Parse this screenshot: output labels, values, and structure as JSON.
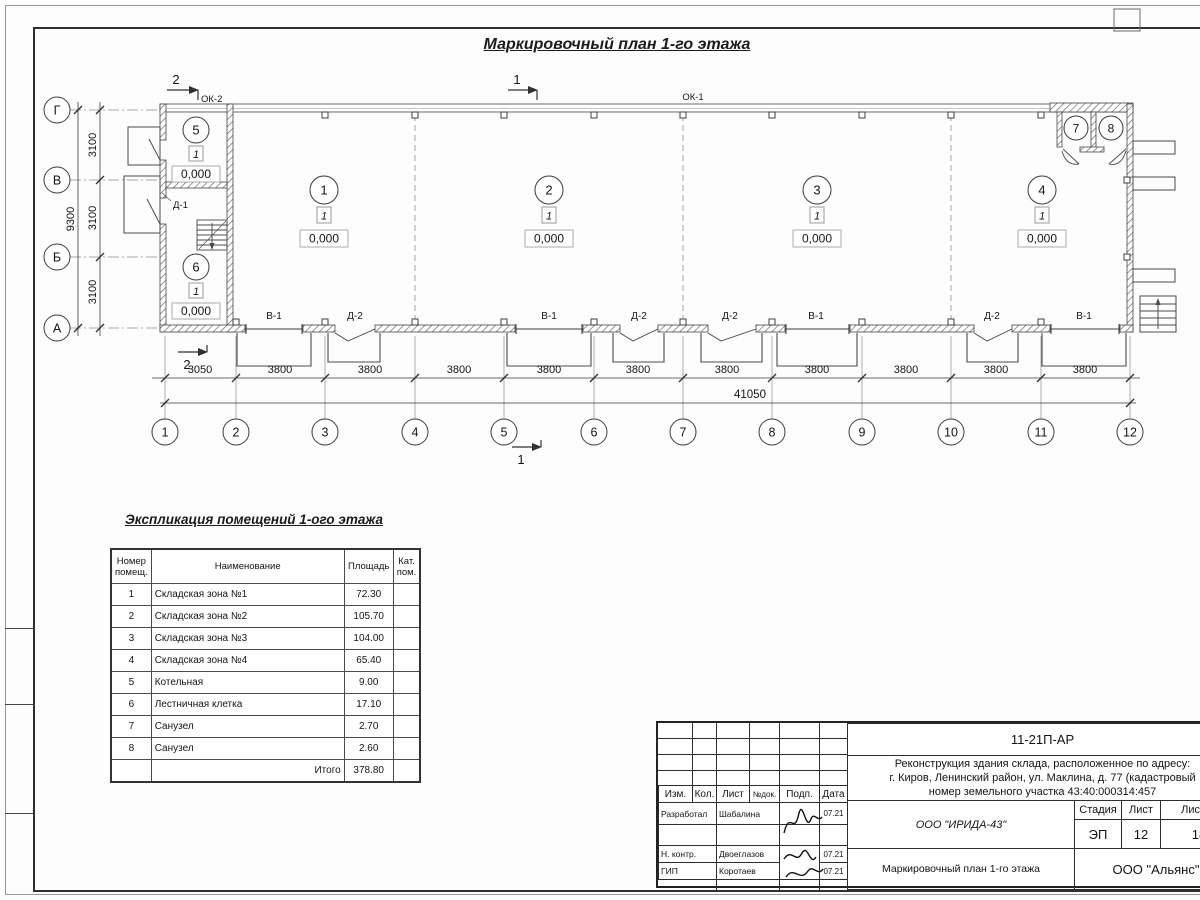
{
  "sheet": {
    "main_title": "Маркировочный план 1-го этажа"
  },
  "plan": {
    "section_markers": {
      "top_left": "2",
      "top_mid": "1",
      "bottom_left": "2",
      "bottom_mid": "1"
    },
    "window_labels": {
      "ok2": "ОК-2",
      "ok1": "ОК-1"
    },
    "door_label": "Д-1",
    "axes_left": [
      "Г",
      "В",
      "Б",
      "А"
    ],
    "axes_bottom": [
      "1",
      "2",
      "3",
      "4",
      "5",
      "6",
      "7",
      "8",
      "9",
      "10",
      "11",
      "12"
    ],
    "dims_bottom": [
      "3050",
      "3800",
      "3800",
      "3800",
      "3800",
      "3800",
      "3800",
      "3800",
      "3800",
      "3800",
      "3800"
    ],
    "dim_total": "41050",
    "dims_left": [
      "3100",
      "3100",
      "3100"
    ],
    "dim_left_total": "9300",
    "opening_labels": [
      "В-1",
      "Д-2",
      "В-1",
      "Д-2",
      "Д-2",
      "В-1",
      "Д-2",
      "В-1"
    ],
    "room_markers": [
      {
        "num": "1",
        "floor": "1",
        "elev": "0,000"
      },
      {
        "num": "2",
        "floor": "1",
        "elev": "0,000"
      },
      {
        "num": "3",
        "floor": "1",
        "elev": "0,000"
      },
      {
        "num": "4",
        "floor": "1",
        "elev": "0,000"
      },
      {
        "num": "5",
        "floor": "1",
        "elev": "0,000"
      },
      {
        "num": "6",
        "floor": "1",
        "elev": "0,000"
      },
      {
        "num": "7"
      },
      {
        "num": "8"
      }
    ]
  },
  "explication": {
    "title": "Экспликация помещений 1-ого этажа",
    "headers": [
      "Номер помещ.",
      "Наименование",
      "Площадь",
      "Кат. пом."
    ],
    "rows": [
      {
        "num": "1",
        "name": "Складская зона №1",
        "area": "72.30",
        "cat": ""
      },
      {
        "num": "2",
        "name": "Складская зона №2",
        "area": "105.70",
        "cat": ""
      },
      {
        "num": "3",
        "name": "Складская зона №3",
        "area": "104.00",
        "cat": ""
      },
      {
        "num": "4",
        "name": "Складская зона №4",
        "area": "65.40",
        "cat": ""
      },
      {
        "num": "5",
        "name": "Котельная",
        "area": "9.00",
        "cat": ""
      },
      {
        "num": "6",
        "name": "Лестничная клетка",
        "area": "17.10",
        "cat": ""
      },
      {
        "num": "7",
        "name": "Санузел",
        "area": "2.70",
        "cat": ""
      },
      {
        "num": "8",
        "name": "Санузел",
        "area": "2.60",
        "cat": ""
      }
    ],
    "total_label": "Итого",
    "total_value": "378.80"
  },
  "title_block": {
    "doc_number": "11-21П-АР",
    "project_line1": "Реконструкция здания склада, расположенное по адресу:",
    "project_line2": "г. Киров, Ленинский район, ул. Маклина, д. 77 (кадастровый",
    "project_line3": "номер земельного участка 43:40:000314:457",
    "columns": [
      "Изм.",
      "Кол.",
      "Лист",
      "№док.",
      "Подп.",
      "Дата"
    ],
    "rows": [
      {
        "role": "Разработал",
        "name": "Шабалина",
        "date": "07.21"
      },
      {
        "role": "Н. контр.",
        "name": "Двоеглазов",
        "date": "07.21"
      },
      {
        "role": "ГИП",
        "name": "Коротаев",
        "date": "07.21"
      }
    ],
    "company": "ООО \"ИРИДА-43\"",
    "sheet_title": "Маркировочный план 1-го этажа",
    "org": "ООО \"Альянс\"",
    "stage_label": "Стадия",
    "sheet_label": "Лист",
    "sheets_label": "Листов",
    "stage": "ЭП",
    "sheet_num": "12",
    "sheets_total": "18"
  }
}
